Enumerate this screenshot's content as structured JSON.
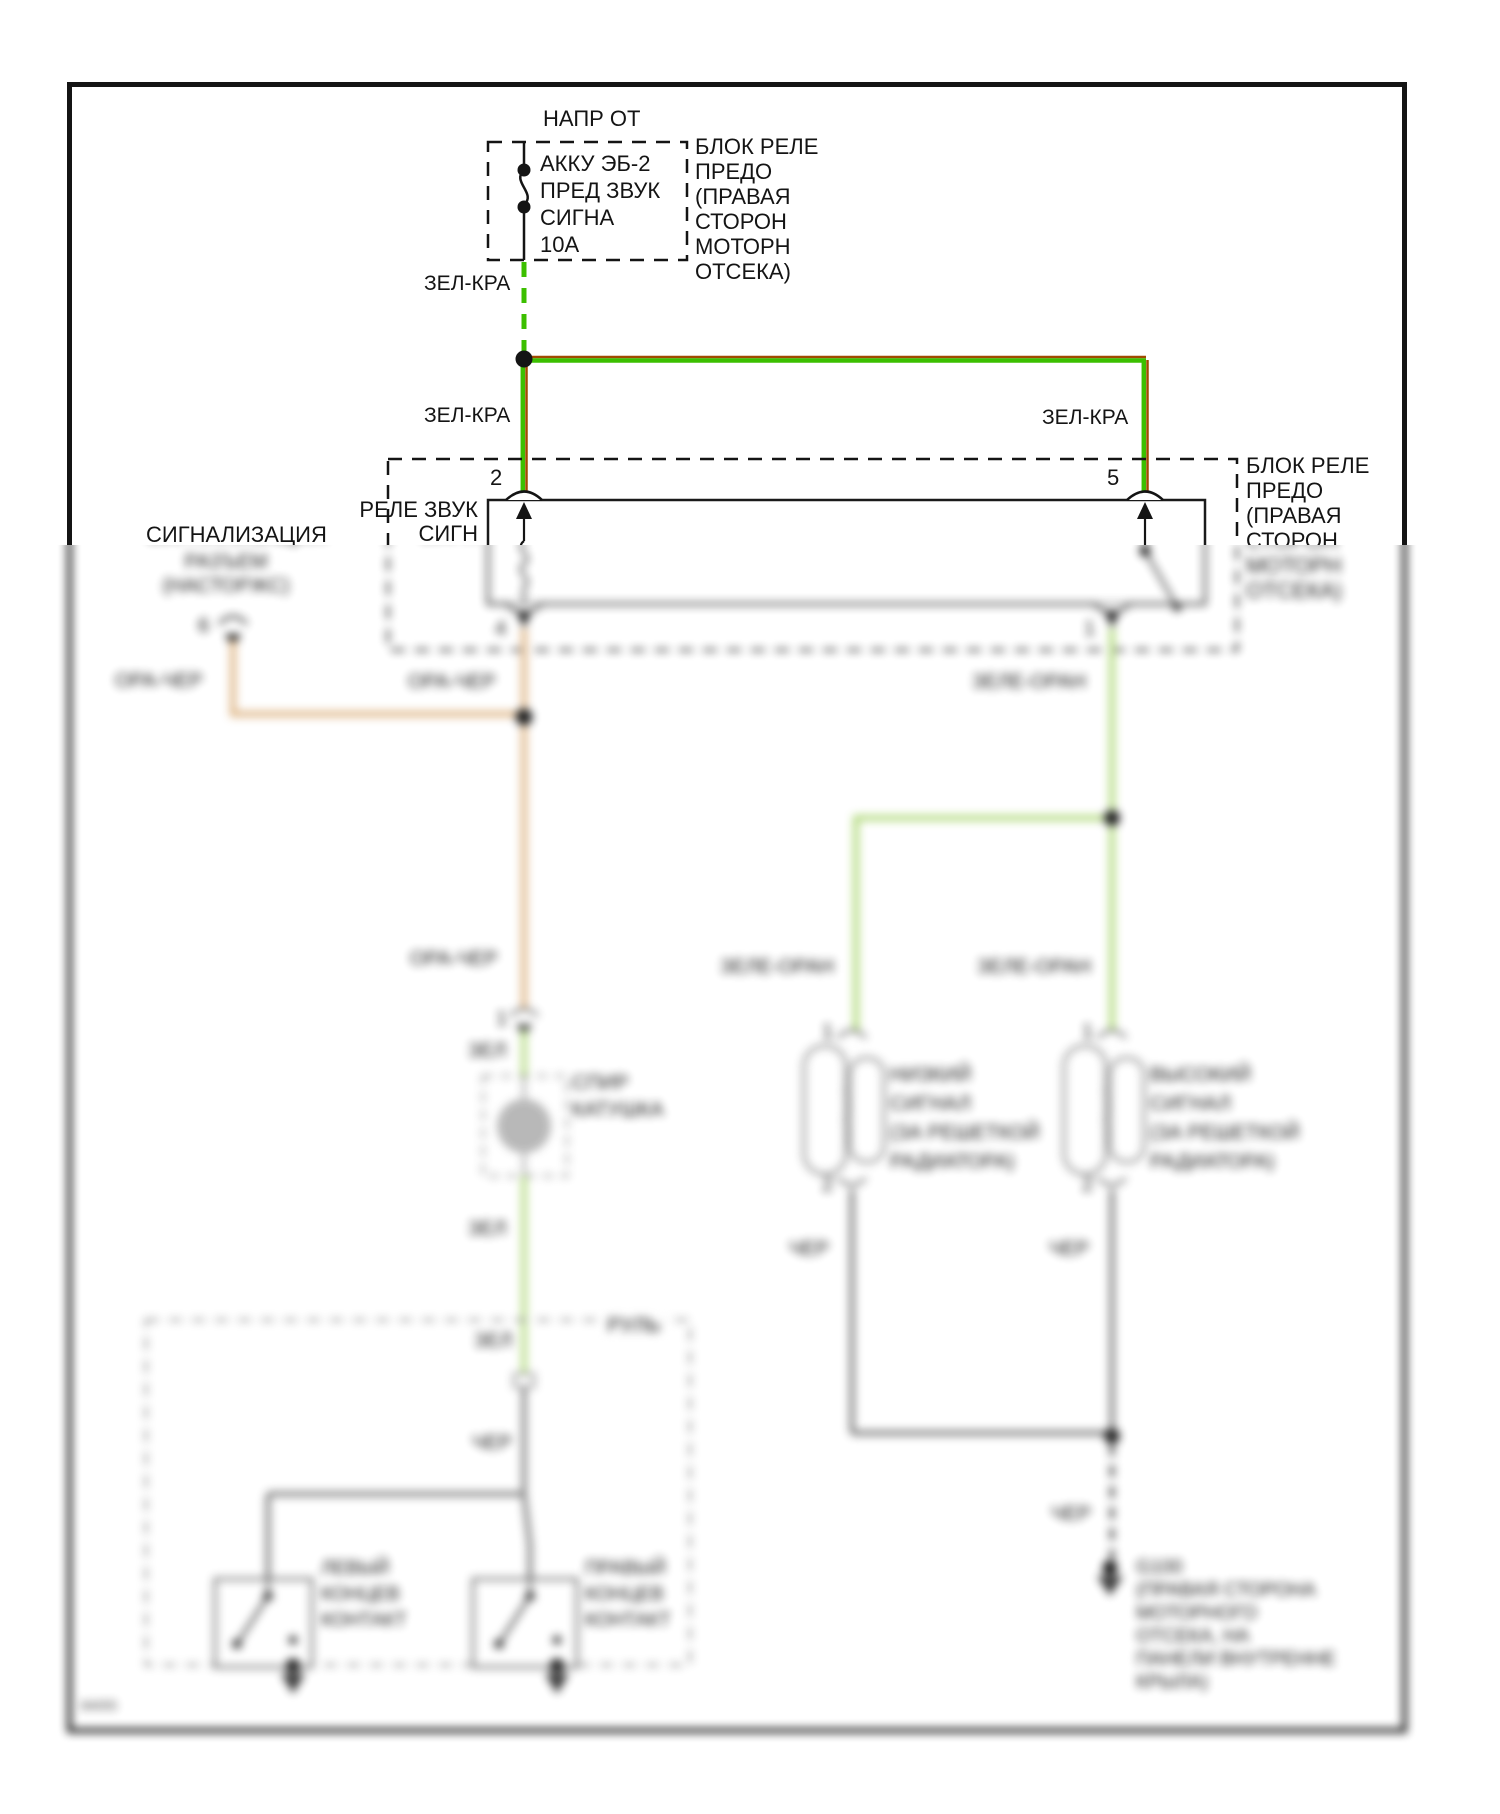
{
  "page": {
    "doc_number": "84055"
  },
  "power": {
    "title": "НАПР ОТ",
    "fuse_lines": [
      "АККУ ЭБ-2",
      "ПРЕД ЗВУК",
      "СИГНА",
      "10А"
    ],
    "block_lines": [
      "БЛОК РЕЛЕ",
      "ПРЕДО",
      "(ПРАВАЯ",
      "СТОРОН",
      "МОТОРН",
      "ОТСЕКА)"
    ]
  },
  "relay": {
    "name_line1": "РЕЛЕ ЗВУК",
    "name_line2": "СИГН",
    "block_lines": [
      "БЛОК РЕЛЕ",
      "ПРЕДО",
      "(ПРАВАЯ",
      "СТОРОН",
      "МОТОРН",
      "ОТСЕКА)"
    ],
    "pin_top_left": "2",
    "pin_top_right": "5",
    "pin_bottom_left": "4",
    "pin_bottom_right": "1"
  },
  "alarm": {
    "title": "СИГНАЛИЗАЦИЯ",
    "line2": "РАЗЪЕМ",
    "line3": "(НАСТОРЖС)",
    "pin": "6"
  },
  "wire_labels": {
    "green_red": "ЗЕЛ-КРА",
    "orange_black": "ОРА-ЧЕР",
    "green_orange": "ЗЕЛЕ-ОРАН",
    "green": "ЗЕЛ",
    "black": "ЧЕР"
  },
  "clockspring": {
    "pin": "1",
    "lines": [
      "СПИР",
      "КАТУШКА"
    ]
  },
  "horn_low": {
    "pin_top": "1",
    "pin_bottom": "2",
    "lines": [
      "НИЗКИЙ",
      "СИГНАЛ",
      "(ЗА РЕШЕТКОЙ",
      "РАДИАТОРА)"
    ]
  },
  "horn_high": {
    "pin_top": "1",
    "pin_bottom": "2",
    "lines": [
      "ВЫСОКИЙ",
      "СИГНАЛ",
      "(ЗА РЕШЕТКОЙ",
      "РАДИАТОРА)"
    ]
  },
  "steering": {
    "label": "РУЛЬ",
    "left_switch_lines": [
      "ЛЕВЫЙ",
      "КОНЦЕВ",
      "КОНТАКТ"
    ],
    "right_switch_lines": [
      "ПРАВЫЙ",
      "КОНЦЕВ",
      "КОНТАКТ"
    ]
  },
  "ground": {
    "lines": [
      "G100",
      "(ПРАВАЯ СТОРОНА",
      "МОТОРНОГО",
      "ОТСЕКА, НА",
      "ПАНЕЛИ ВНУТРЕННЕ",
      "КРЫЛА)"
    ]
  },
  "colors": {
    "wire_green": "#3cbf00",
    "wire_red_stripe": "#a04a00",
    "wire_green_light": "#a9d56f",
    "wire_orange": "#ddb382",
    "wire_gray": "#6f6f6f",
    "line_black": "#141414"
  }
}
